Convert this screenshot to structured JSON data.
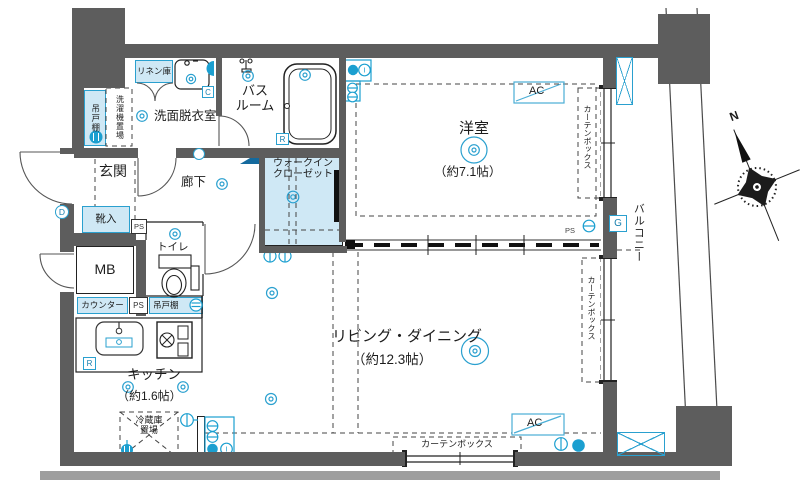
{
  "plan": {
    "rooms": {
      "washroom": "洗面脱衣室",
      "bath_l1": "バス",
      "bath_l2": "ルーム",
      "linen": "リネン庫",
      "hanging_cupboard": "吊戸棚",
      "washer_space": "洗濯機置場",
      "entrance": "玄関",
      "shoe_box": "靴入",
      "meter_box": "MB",
      "toilet": "トイレ",
      "hallway": "廊下",
      "wic_l1": "ウォークイン",
      "wic_l2": "クローゼット",
      "western_room": "洋室",
      "western_size": "（約7.1帖）",
      "living": "リビング・ダイニング",
      "living_size": "（約12.3帖）",
      "kitchen": "キッチン",
      "kitchen_size": "（約1.6帖）",
      "fridge_l1": "冷蔵庫",
      "fridge_l2": "置場",
      "counter": "カウンター",
      "balcony": "バルコニー",
      "curtain_box": "カーテンボックス"
    },
    "badges": {
      "ps": "PS",
      "ac": "AC",
      "c": "C",
      "r": "R",
      "g": "G",
      "d": "D",
      "i": "I",
      "n": "N"
    },
    "colors": {
      "wall": "#5d5d5d",
      "accent": "#1b9fd0",
      "room_fill": "#cfe8f5"
    }
  }
}
